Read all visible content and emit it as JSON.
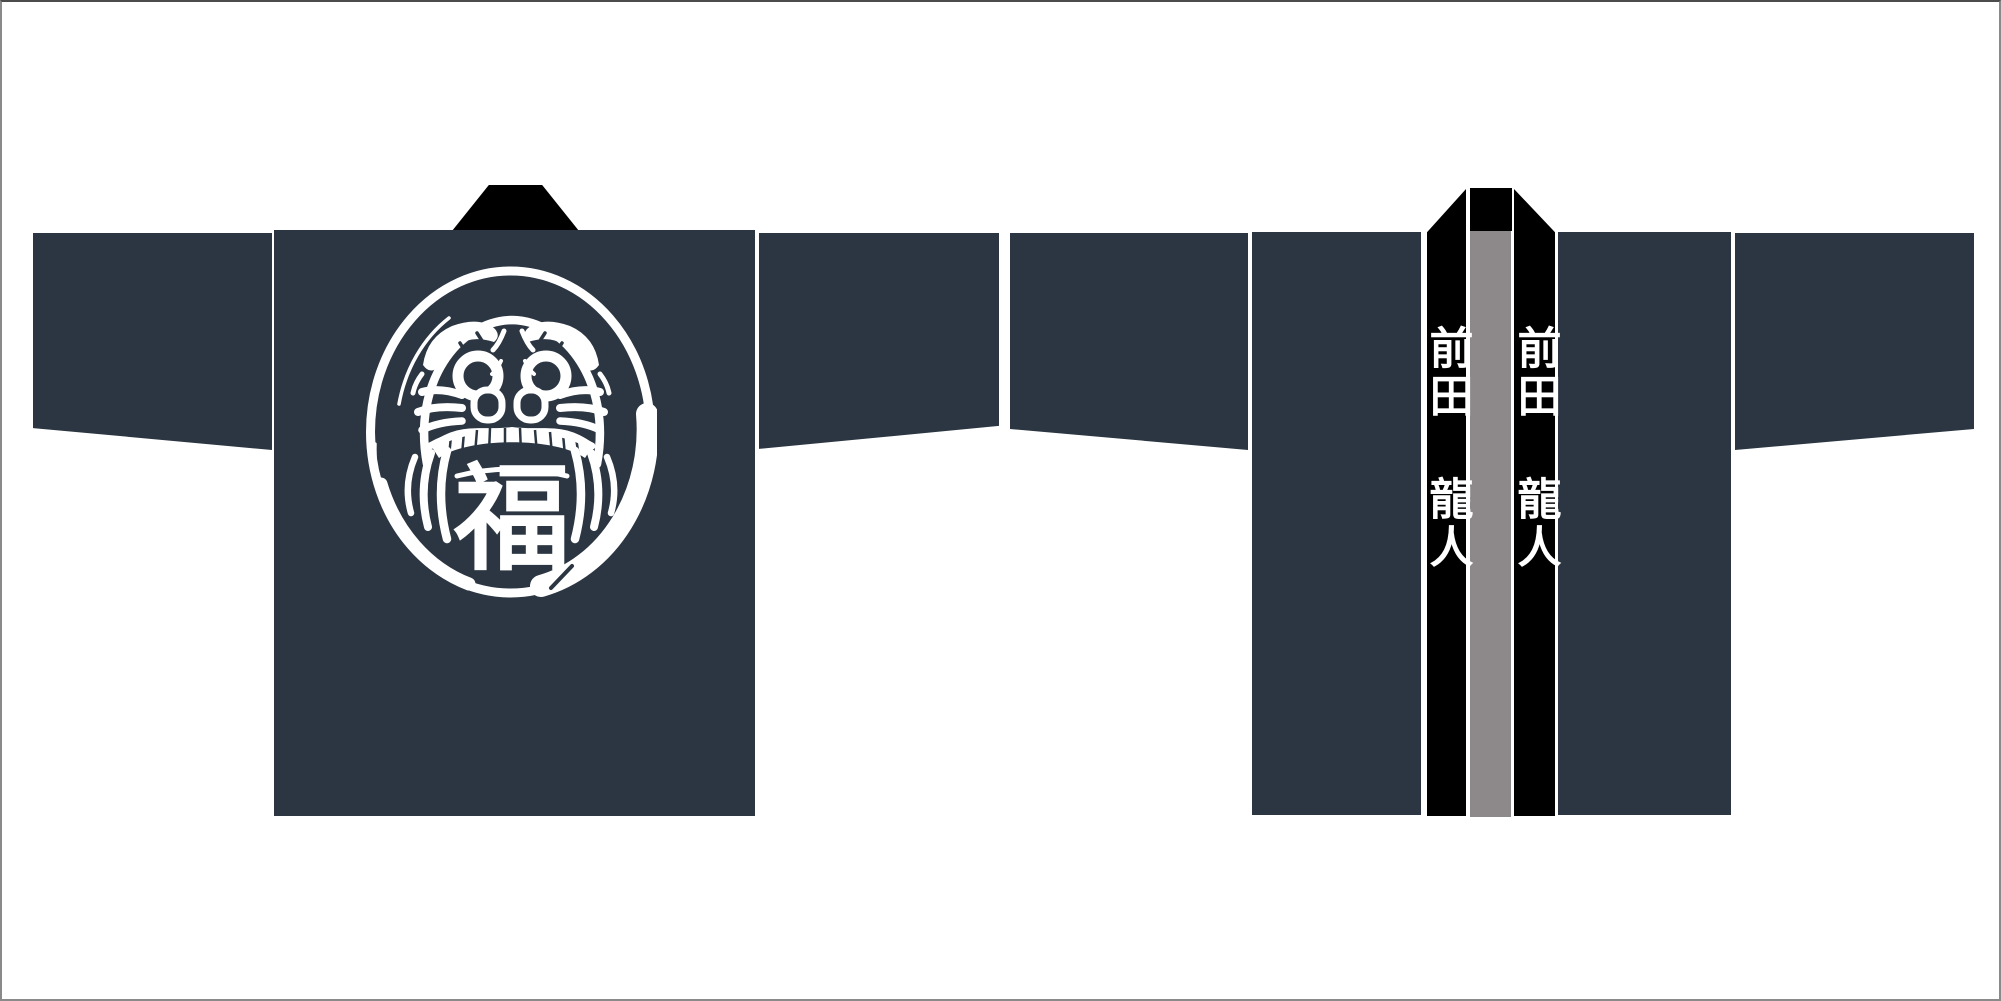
{
  "palette": {
    "fabric_navy": "#2b3642",
    "collar_black": "#000000",
    "lining_gray": "#8d8889",
    "print_white": "#ffffff",
    "frame_gray": "#8a8a8a",
    "background_white": "#ffffff"
  },
  "back_view": {
    "emblem": {
      "icon": "daruma-face-icon",
      "character": "福"
    }
  },
  "front_view": {
    "collar_text_left": "前田 龍人",
    "collar_text_right": "前田 龍人"
  }
}
